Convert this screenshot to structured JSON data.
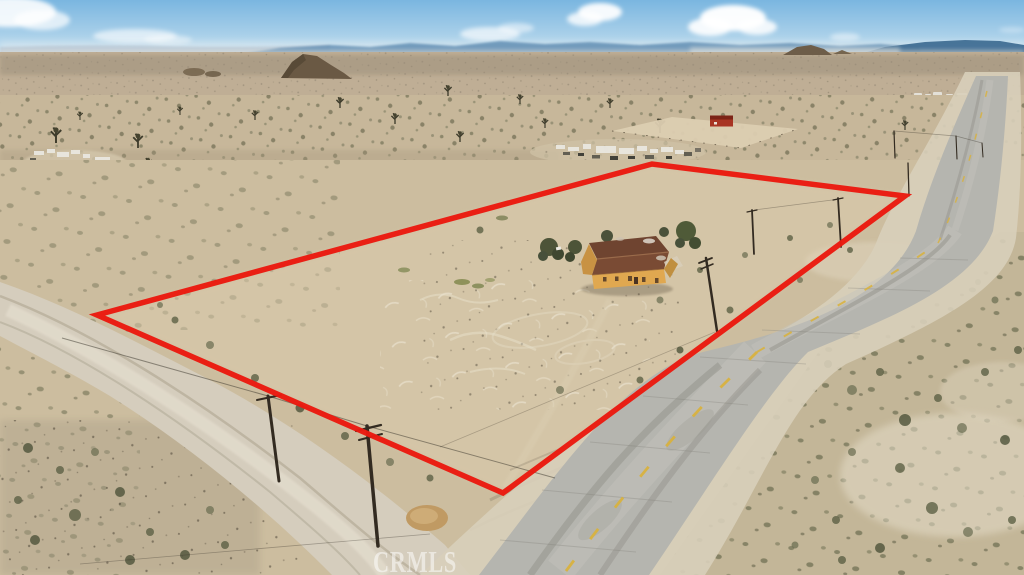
{
  "image": {
    "alt": "Aerial drone photograph of a flat desert land parcel outlined with a red boundary polygon, containing a small yellow house with a brown roof, beside a two-lane paved road running diagonally; dirt road and utility poles at lower left, scattered trailers and a red barn structure on neighboring land, scrub desert plain, distant blue mountains and light blue sky with clouds",
    "watermark_text": "CRMLS"
  },
  "colors": {
    "boundary_red": "#ea1a10",
    "sky_top": "#7ab6e0",
    "sky_horizon": "#d9ebf5",
    "mountains_blue": "#5f8cb2",
    "mountains_dark_blue": "#406e94",
    "desert_tan": "#c7b79a",
    "parcel_dirt": "#d2c3a5",
    "dirt_road_tan": "#d5cdbd",
    "asphalt_gray": "#b5b5af",
    "road_shoulder": "#d8cfba",
    "lane_dash_yellow": "#d9b139",
    "house_roof_brown": "#7a4b34",
    "house_wall_yellow": "#e0a850",
    "barn_red": "#a83423",
    "watermark_white": "rgba(255,255,255,0.52)"
  }
}
